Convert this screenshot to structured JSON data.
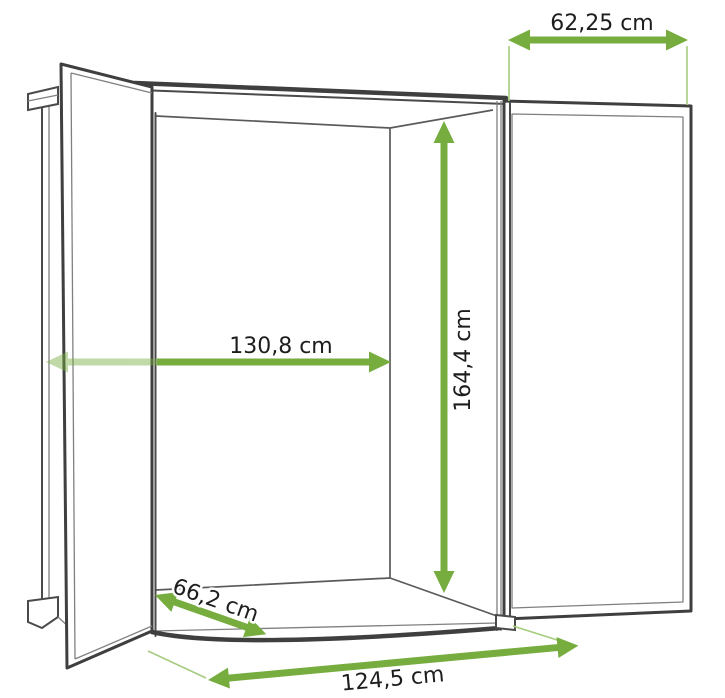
{
  "diagram": {
    "type": "furniture-dimension-diagram",
    "subject": "wardrobe wireframe with two open doors",
    "unit": "cm",
    "dimensions": {
      "door_width": {
        "label": "62,25 cm",
        "value": 62.25,
        "orientation": "horizontal",
        "location": "top right, across open right door"
      },
      "interior_width": {
        "label": "130,8 cm",
        "value": 130.8,
        "orientation": "horizontal",
        "location": "middle, interior width"
      },
      "interior_height": {
        "label": "164,4 cm",
        "value": 164.4,
        "orientation": "vertical",
        "location": "interior height, right side"
      },
      "interior_depth": {
        "label": "66,2 cm",
        "value": 66.2,
        "orientation": "diagonal",
        "location": "bottom left, interior depth"
      },
      "base_width": {
        "label": "124,5 cm",
        "value": 124.5,
        "orientation": "diagonal",
        "location": "bottom, front base width"
      }
    },
    "colors": {
      "arrow": "#76ad3e",
      "extension": "#a6cc7f",
      "outline_dark": "#3f3f3f",
      "outline_medium": "#5a5a5a",
      "outline_thin": "#808080",
      "text": "#1d1d1d",
      "background": "#ffffff"
    }
  }
}
